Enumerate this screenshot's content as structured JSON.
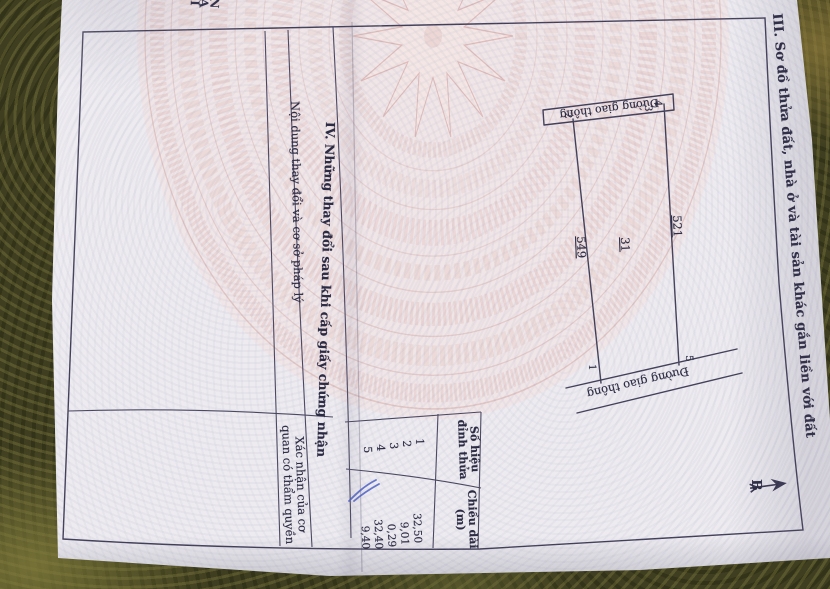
{
  "document": {
    "edge_text": "NAI",
    "section3": {
      "title": "III. Sơ đồ thửa đất, nhà ở và tài sản khác gắn liền với đất",
      "north_label": "B",
      "sketch": {
        "road_label_top": "Đường giao thông",
        "road_label_bottom": "Đường giao thông",
        "parcel_number": "31",
        "adjacent_parcels": [
          "549",
          "521"
        ],
        "vertex_labels": [
          "1",
          "2",
          "3",
          "4",
          "5"
        ]
      },
      "vertex_table": {
        "col1_header_lines": [
          "Số hiệu",
          "đỉnh thửa"
        ],
        "col2_header_lines": [
          "Chiều dài",
          "(m)"
        ],
        "rows": [
          {
            "vertex": "1",
            "length": "32,50"
          },
          {
            "vertex": "2",
            "length": "9,01"
          },
          {
            "vertex": "3",
            "length": "0,29"
          },
          {
            "vertex": "4",
            "length": "32,40"
          },
          {
            "vertex": "5",
            "length": "9,40"
          }
        ]
      }
    },
    "section4": {
      "title": "IV. Những thay đổi sau khi cấp giấy chứng nhận",
      "col1_header": "Nội dung thay đổi và cơ sở pháp lý",
      "col2_header_lines": [
        "Xác nhận của cơ",
        "quan có thẩm quyền"
      ]
    },
    "colors": {
      "tablecloth": "#3f3e20",
      "paper": "#edebf0",
      "ink": "#413e58",
      "drum_pink": "#e6c6c3",
      "pen_mark": "#4a5fc4"
    }
  }
}
